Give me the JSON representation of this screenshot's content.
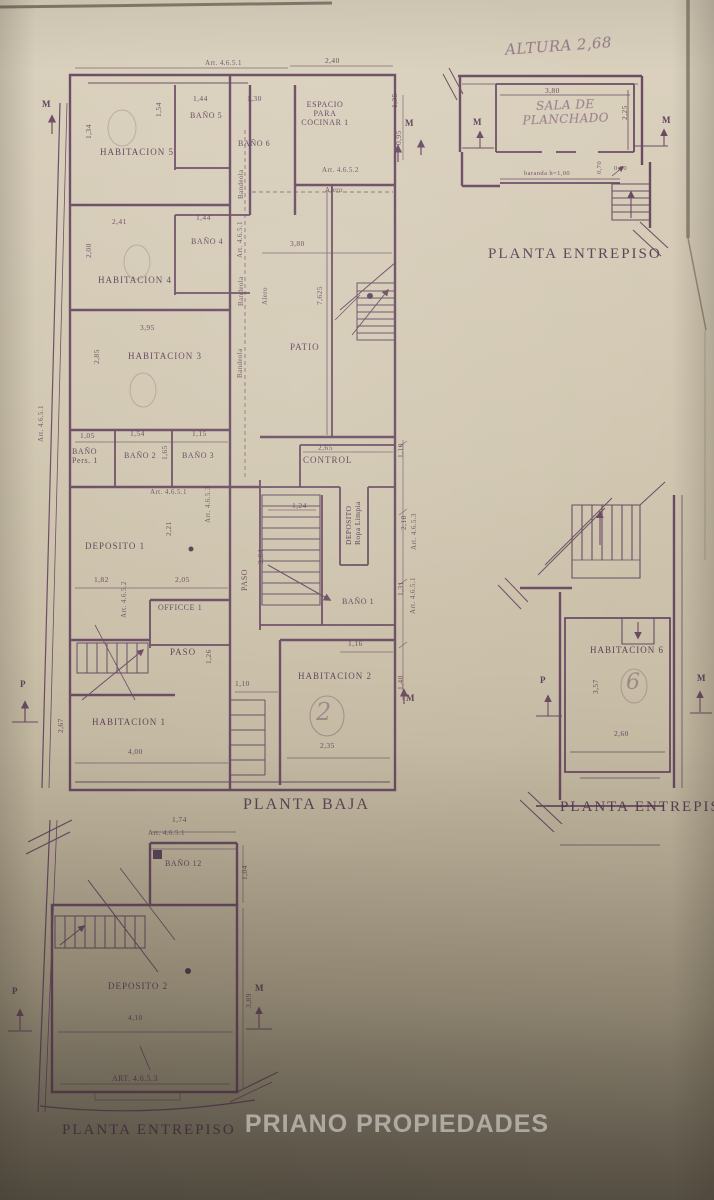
{
  "colors": {
    "ink": "#5c3a58",
    "paper": "#cfc4ae",
    "wm": "#f4f1e8"
  },
  "watermark": "PRIANO PROPIEDADES",
  "planta_baja": {
    "caption": "PLANTA BAJA",
    "art_top": "Art. 4.6.5.1",
    "art_left": "Art. 4.6.5.1",
    "art_cocina": "Art. 4.6.5.2",
    "art_center": "Art. 4.6.5.1",
    "art_banos": "Art. 4.6.5.1",
    "art_mid": "Art. 4.6.5.3",
    "art_office": "Art. 4.6.5.2",
    "art_right_1": "Art. 4.6.5.1",
    "art_right_3": "Art. 4.6.5.3",
    "alero_top": "Alero",
    "alero_mid": "Alero",
    "bandeola_1": "Bandeola",
    "bandeola_2": "Bandeola",
    "bandeola_3": "Bandeola",
    "rooms": {
      "habitacion5": "HABITACION 5",
      "bano5": "BAÑO 5",
      "bano6": "BAÑO 6",
      "cocina": "ESPACIO PARA COCINAR 1",
      "habitacion4": "HABITACION 4",
      "bano4": "BAÑO 4",
      "habitacion3": "HABITACION 3",
      "patio": "PATIO",
      "bano_pers": "BAÑO Pers. 1",
      "bano2": "BAÑO 2",
      "bano3": "BAÑO 3",
      "control": "CONTROL",
      "deposito1": "DEPOSITO 1",
      "deposito_ropa_1": "DEPOSITO",
      "deposito_ropa_2": "Ropa Limpia",
      "bano1": "BAÑO 1",
      "office1": "OFFICCE 1",
      "paso_left": "PASO",
      "paso_center": "PASO",
      "habitacion2": "HABITACION 2",
      "habitacion1": "HABITACION 1"
    },
    "dims": {
      "top_240": "2,40",
      "hab5_134": "1,34",
      "bano5_left": "1,54",
      "bano5_144": "1,44",
      "bano6_130": "1,30",
      "right_135": "1,35",
      "right_095": "0,95",
      "hab4_241": "2,41",
      "bano4_144": "1,44",
      "hab4_200": "2,00",
      "hab3_395": "3,95",
      "hab3_285": "2,85",
      "patio_380": "3,80",
      "patio_7625": "7,625",
      "banop_105": "1,05",
      "bano2_154": "1,54",
      "bano2_165": "1,65",
      "bano3_115": "1,15",
      "control_265": "2,65",
      "dep1_221": "2,21",
      "stairs_124": "1,24",
      "paso_364": "3,64",
      "dep1_182": "1,82",
      "office_205": "2,05",
      "paso_126": "1,26",
      "hab2_110": "1,10",
      "hab2_116": "1,16",
      "hab2_235": "2,35",
      "hab1_267": "2,67",
      "hab1_400": "4,00",
      "right_110": "1,10",
      "right_218": "2,18",
      "right_131": "1,31",
      "right_140": "1,40"
    },
    "markers": {
      "m_topleft": "M",
      "m_topright": "M",
      "p_left": "P",
      "m_bottomright": "M"
    },
    "circled": {
      "hab2": "2"
    }
  },
  "entrepiso_top": {
    "caption": "PLANTA ENTREPISO",
    "altura_note": "ALTURA 2,68",
    "room": "SALA DE PLANCHADO",
    "dims": {
      "w": "3,80",
      "h": "2,25",
      "baranda": "baranda h=1,00",
      "d070a": "0,70",
      "d070b": "0,70"
    },
    "markers": {
      "m_left": "M",
      "m_right": "M"
    }
  },
  "entrepiso_mid": {
    "caption": "PLANTA ENTREPISO",
    "room": "HABITACION 6",
    "dims": {
      "h": "3,57",
      "w": "2,60"
    },
    "markers": {
      "p_left": "P",
      "m_right": "M"
    },
    "circled": "6"
  },
  "entrepiso_bottom": {
    "caption": "PLANTA ENTREPISO",
    "art_top": "Art. 4.6.5.1",
    "art_bottom": "ART. 4.6.5.3",
    "rooms": {
      "bano12": "BAÑO 12",
      "deposito2": "DEPOSITO 2"
    },
    "dims": {
      "top_174": "1,74",
      "right_104": "1,04",
      "w_410": "4,10",
      "right_389": "3,89"
    },
    "markers": {
      "m_right": "M",
      "p_left": "P"
    }
  }
}
